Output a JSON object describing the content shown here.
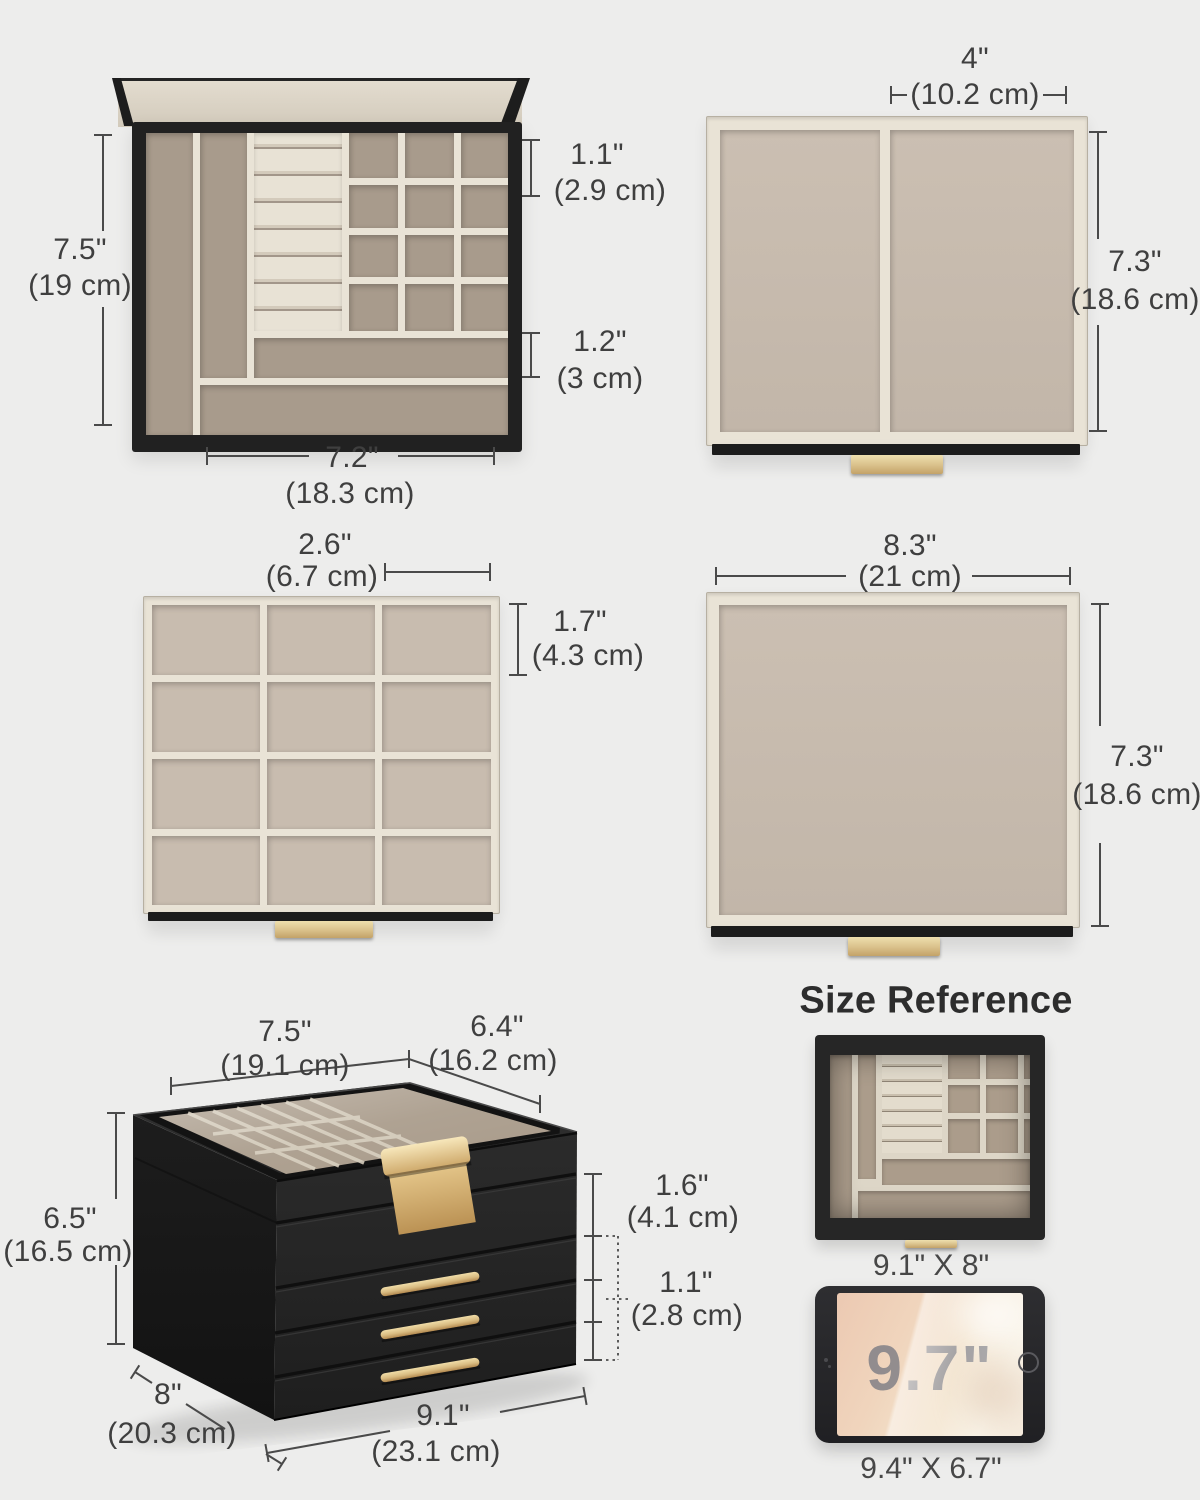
{
  "colors": {
    "background": "#ededec",
    "ink": "#3f3f3f",
    "line": "#4a4a4a",
    "black_frame": "#212121",
    "cream": "#e9e3d6",
    "floor_dark": "#a89b8c",
    "floor_light": "#c6baad",
    "lid_beige": "#d9d2c3",
    "gold": "#d9bd84",
    "gold_dark": "#b8955c",
    "title_ink": "#2d2d2d",
    "watermark": "#8d8d93"
  },
  "panels": {
    "tray_top_left": {
      "height_in": "7.5\"",
      "height_cm": "(19 cm)",
      "small_slot_height_in": "1.1\"",
      "small_slot_height_cm": "(2.9 cm)",
      "long_slot_height_in": "1.2\"",
      "long_slot_height_cm": "(3 cm)",
      "width_in": "7.2\"",
      "width_cm": "(18.3 cm)"
    },
    "tray_top_right": {
      "right_section_width_in": "4\"",
      "right_section_width_cm": "(10.2 cm)",
      "depth_in": "7.3\"",
      "depth_cm": "(18.6 cm)"
    },
    "tray_mid_left": {
      "cell_width_in": "2.6\"",
      "cell_width_cm": "(6.7 cm)",
      "cell_height_in": "1.7\"",
      "cell_height_cm": "(4.3 cm)"
    },
    "tray_mid_right": {
      "width_in": "8.3\"",
      "width_cm": "(21 cm)",
      "depth_in": "7.3\"",
      "depth_cm": "(18.6 cm)"
    },
    "jewelry_box": {
      "lid_width_in": "7.5\"",
      "lid_width_cm": "(19.1 cm)",
      "lid_depth_in": "6.4\"",
      "lid_depth_cm": "(16.2 cm)",
      "height_in": "6.5\"",
      "height_cm": "(16.5 cm)",
      "top_section_height_in": "1.6\"",
      "top_section_height_cm": "(4.1 cm)",
      "drawer_height_in": "1.1\"",
      "drawer_height_cm": "(2.8 cm)",
      "base_depth_in": "8\"",
      "base_depth_cm": "(20.3 cm)",
      "base_width_in": "9.1\"",
      "base_width_cm": "(23.1 cm)"
    },
    "size_reference": {
      "title": "Size Reference",
      "organizer_footprint": "9.1\" X 8\"",
      "tablet_screen_size": "9.7\"",
      "tablet_footprint": "9.4\" X 6.7\""
    }
  }
}
